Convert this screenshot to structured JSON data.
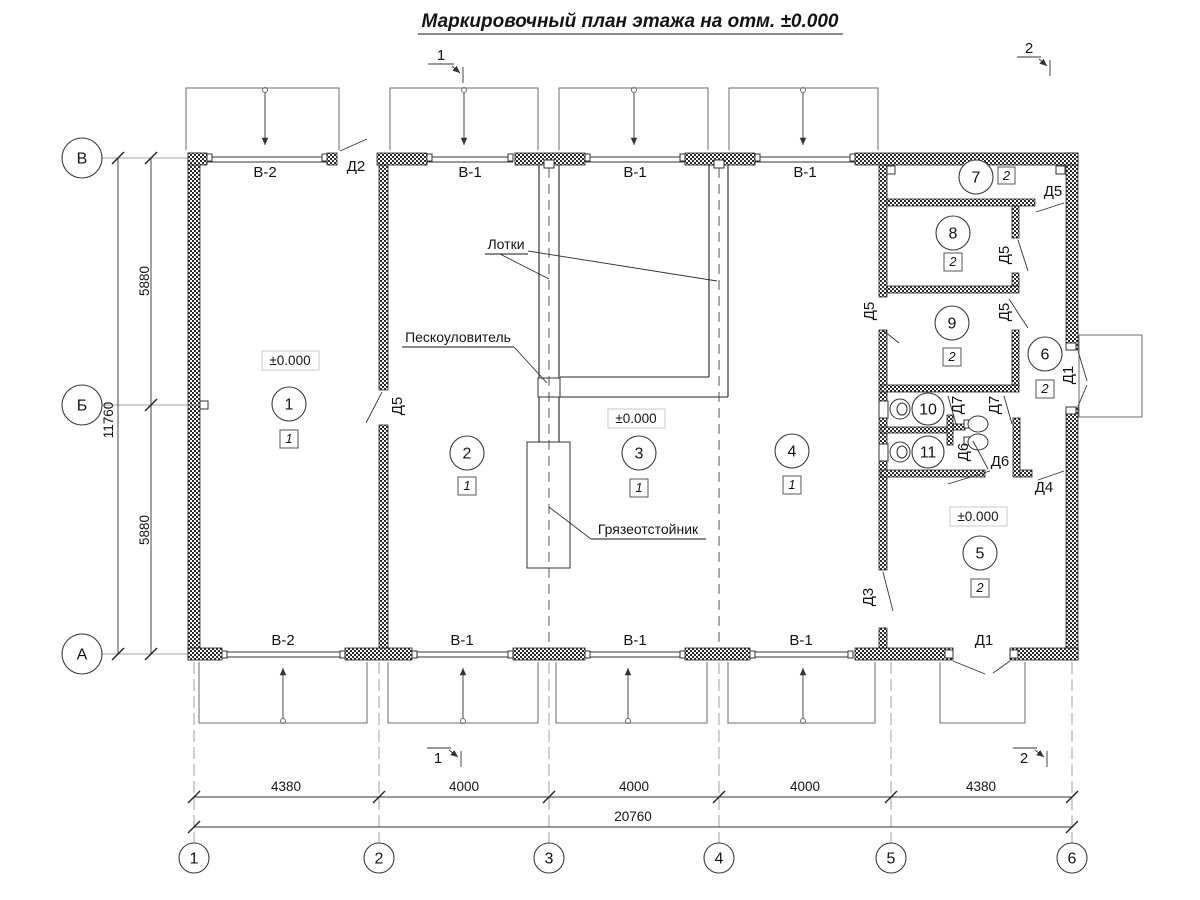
{
  "title": "Маркировочный план этажа на отм. ±0.000",
  "sections": {
    "s1": "1",
    "s2": "2"
  },
  "axes": {
    "left": [
      "В",
      "Б",
      "А"
    ],
    "bottom": [
      "1",
      "2",
      "3",
      "4",
      "5",
      "6"
    ]
  },
  "dims": {
    "left_segments": [
      "5880",
      "5880"
    ],
    "left_total": "11760",
    "bottom_segments": [
      "4380",
      "4000",
      "4000",
      "4000",
      "4380"
    ],
    "bottom_total": "20760"
  },
  "windows": {
    "top": [
      "В-2",
      "В-1",
      "В-1",
      "В-1"
    ],
    "bottom": [
      "В-2",
      "В-1",
      "В-1",
      "В-1"
    ]
  },
  "doors": {
    "d1": "Д1",
    "d2": "Д2",
    "d3": "Д3",
    "d4": "Д4",
    "d5": "Д5",
    "d6": "Д6",
    "d7": "Д7"
  },
  "rooms": {
    "r1": {
      "num": "1",
      "cat": "1"
    },
    "r2": {
      "num": "2",
      "cat": "1"
    },
    "r3": {
      "num": "3",
      "cat": "1"
    },
    "r4": {
      "num": "4",
      "cat": "1"
    },
    "r5": {
      "num": "5",
      "cat": "2"
    },
    "r6": {
      "num": "6",
      "cat": "2"
    },
    "r7": {
      "num": "7",
      "cat": "2"
    },
    "r8": {
      "num": "8",
      "cat": "2"
    },
    "r9": {
      "num": "9",
      "cat": "2"
    },
    "r10": {
      "num": "10"
    },
    "r11": {
      "num": "11"
    }
  },
  "elevation_mark": "±0.000",
  "annotations": {
    "trays": "Лотки",
    "sand_trap": "Пескоуловитель",
    "mud_settler": "Грязеотстойник"
  },
  "colors": {
    "line": "#1a1a1a",
    "secondary": "#555555",
    "background": "#ffffff"
  }
}
